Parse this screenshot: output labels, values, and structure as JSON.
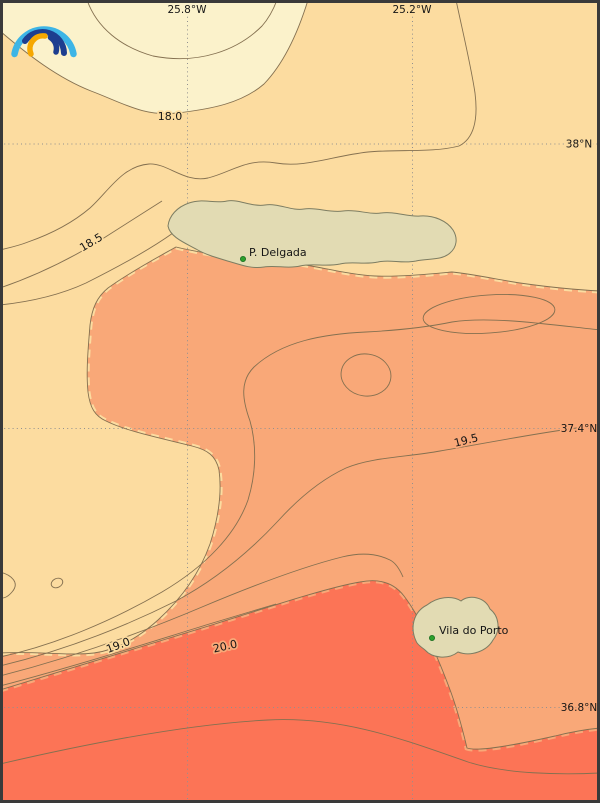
{
  "map": {
    "grid": {
      "meridian_labels": [
        "25.8°W",
        "25.2°W"
      ],
      "parallel_labels": [
        "38°N",
        "37.4°N",
        "36.8°N"
      ]
    },
    "contour_labels": [
      "18.0",
      "18.5",
      "19.5",
      "19.0",
      "20.0"
    ],
    "places": [
      {
        "name": "P. Delgada"
      },
      {
        "name": "Vila do Porto"
      }
    ],
    "colors": {
      "band_cream": "#fbf2cb",
      "band_peach": "#fcdca0",
      "band_orange": "#f9a878",
      "band_red": "#fc7456",
      "land": "#e2dbb3",
      "coast": "#7d7d62",
      "contour_line": "#847050",
      "grid_line": "#909090",
      "place_dot": "#2ca02c",
      "place_dot_edge": "#1c6e22",
      "frame": "#3a3a3a",
      "logo_light_blue": "#3db5e6",
      "logo_dark_blue": "#1d3e8f",
      "logo_orange": "#f6a800"
    }
  }
}
